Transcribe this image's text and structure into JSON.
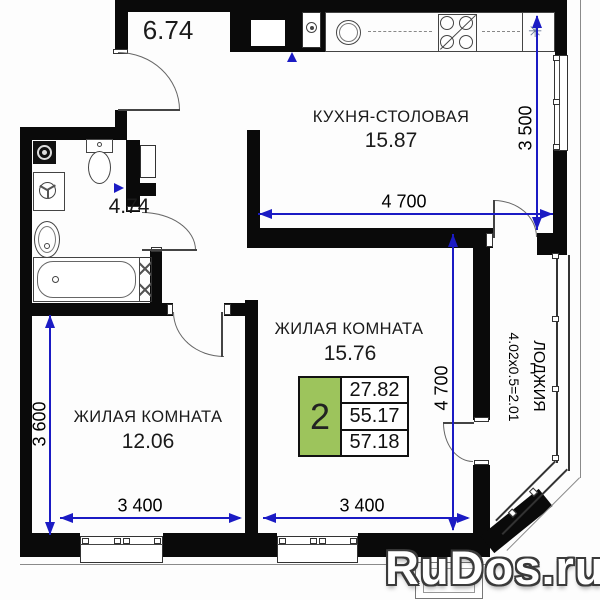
{
  "plan": {
    "rooms": {
      "kitchen": {
        "name": "КУХНЯ-СТОЛОВАЯ",
        "area": "15.87"
      },
      "living2": {
        "name": "ЖИЛАЯ КОМНАТА",
        "area": "15.76"
      },
      "living1": {
        "name": "ЖИЛАЯ КОМНАТА",
        "area": "12.06"
      },
      "loggia": {
        "name": "ЛОДЖИЯ",
        "size": "4.02х0.5=2.01"
      }
    },
    "dimensions": {
      "hall_area": "6.74",
      "bathroom_area": "4.74",
      "kitchen_depth": "3 500",
      "kitchen_width": "4 700",
      "living2_depth": "4 700",
      "living1_depth": "3 600",
      "living1_width": "3 400",
      "living2_width": "3 400"
    },
    "info_table": {
      "rooms_count": "2",
      "living_area": "27.82",
      "area_without_loggia": "55.17",
      "total_area": "57.18"
    },
    "colors": {
      "wall": "#0a0a0a",
      "dimension_blue": "#1b1bc4",
      "table_green": "#9dc45c"
    }
  },
  "watermark": {
    "text": "RuDos.ru"
  }
}
